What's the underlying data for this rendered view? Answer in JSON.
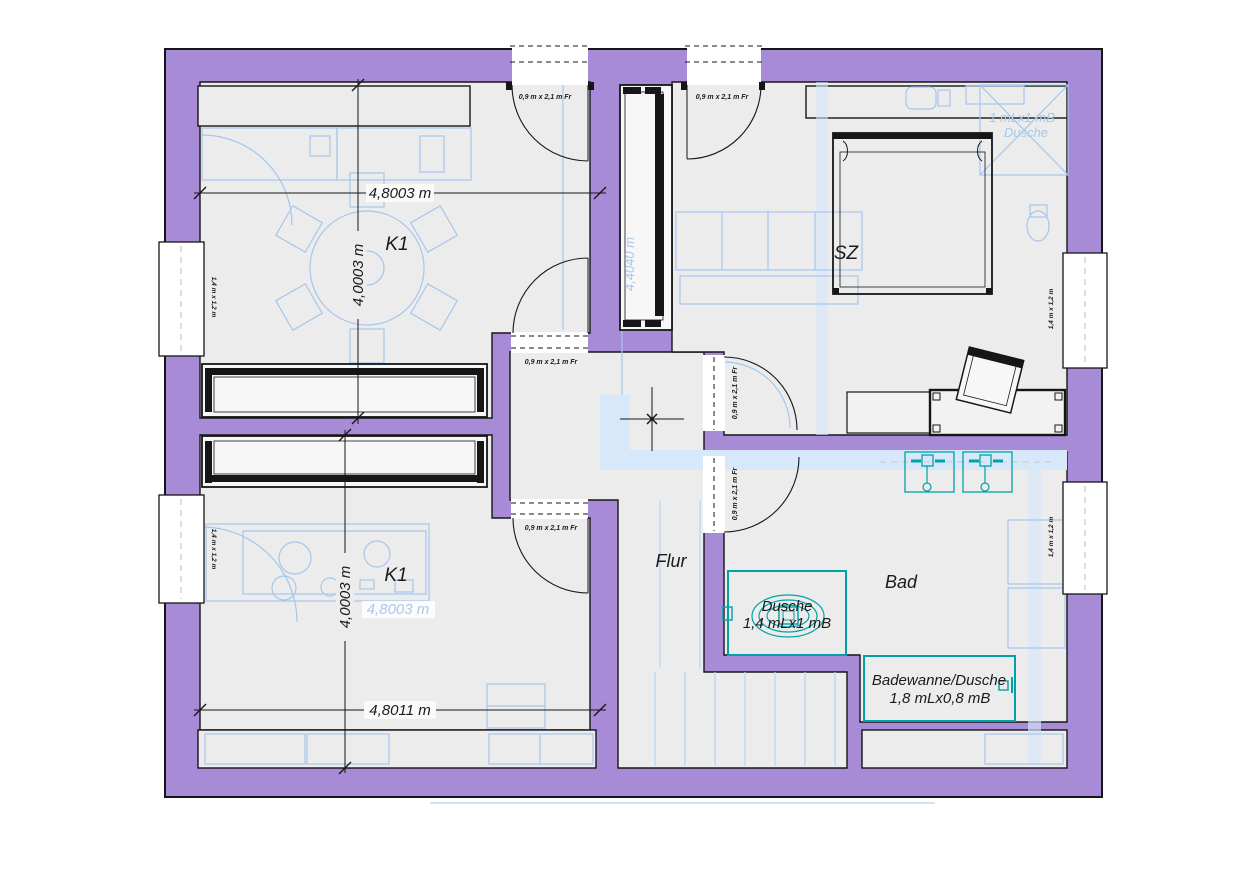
{
  "plan": {
    "rooms": {
      "k1_upper": "K1",
      "k1_lower": "K1",
      "bedroom": "SZ",
      "hall": "Flur",
      "bath": "Bad"
    },
    "dimensions": {
      "upper_width": "4,8003 m",
      "upper_height": "4,0003 m",
      "lower_height": "4,0003 m",
      "lower_width": "4,8011 m"
    },
    "labels": {
      "door": "0,9 m x 2,1 m Fr",
      "window": "1,4 m x 1,2 m"
    },
    "fixtures": {
      "shower": {
        "name": "Dusche",
        "size": "1,4 mLx1 mB"
      },
      "bathtub": {
        "name": "Badewanne/Dusche",
        "size": "1,8 mLx0,8 mB"
      }
    },
    "ghost": {
      "width": "4,8003 m",
      "height": "4,4040 m",
      "shower_size": "1 mLx1 mB",
      "shower_name": "Dusche"
    },
    "colors": {
      "wall": "#a78bd7",
      "floor": "#ececec",
      "ghost": "#a6c6ec",
      "ghost_fill": "#d7e8fa",
      "sanitary": "#00a2a6",
      "ink": "#161616"
    }
  }
}
